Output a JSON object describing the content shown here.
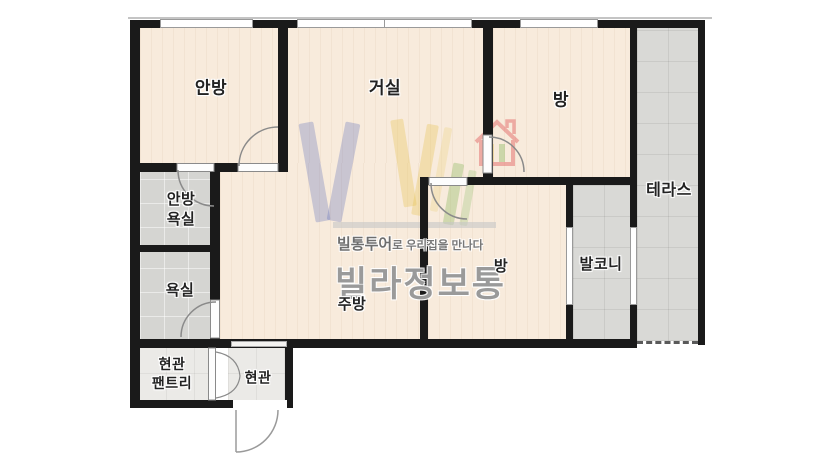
{
  "page": {
    "type": "apartment-floorplan-screenshot",
    "background": "#ffffff"
  },
  "rooms": {
    "master_bedroom": {
      "label": "안방"
    },
    "living_room": {
      "label": "거실"
    },
    "bedroom_upper": {
      "label": "방"
    },
    "bedroom_middle": {
      "label": "방"
    },
    "kitchen": {
      "label": "주방"
    },
    "terrace": {
      "label": "테라스"
    },
    "balcony": {
      "label": "발코니"
    },
    "master_bathroom": {
      "line1": "안방",
      "line2": "욕실"
    },
    "bathroom": {
      "label": "욕실"
    },
    "entrance_pantry": {
      "line1": "현관",
      "line2": "팬트리"
    },
    "entrance": {
      "label": "현관"
    }
  },
  "watermark": {
    "tagline_emphasis": "빌통투어",
    "tagline_rest": "로 우리집을 만나다",
    "brand": "빌라정보통"
  },
  "colors": {
    "wall": "#1a1a1a",
    "wood_floor": "#f8ebdc",
    "tile_floor": "#d9d9d6",
    "bath_floor": "#d5d5d2",
    "entry_floor": "#ebeae7",
    "logo_blue": "#5e6eb8",
    "logo_yellow": "#e5c24b",
    "logo_green": "#7cb14f",
    "logo_red": "#e05c5c",
    "logo_gray": "#9a9a9a"
  }
}
